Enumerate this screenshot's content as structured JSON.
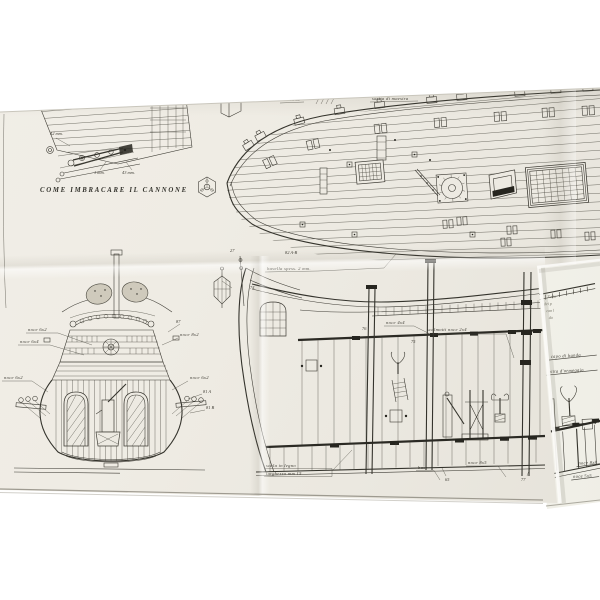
{
  "palette": {
    "paper": "#efece4",
    "paper_under": "#f6f5f0",
    "ink": "#3e3c35",
    "shadow": "#b9b5a9"
  },
  "sheet": {
    "cannon": {
      "caption": "COME IMBRACARE IL CANNONE",
      "dims": [
        "42 mm.",
        "1 mm.",
        "43 mm."
      ]
    },
    "deck": {
      "mezzana": "mezzana",
      "sartia": "sartia di maestra",
      "n82": "82 A-B",
      "bavella": "bavella spess. 2 mm.",
      "n27": "27",
      "n74": "74"
    },
    "stern": {
      "noce62a": "noce 6x2",
      "noce64": "noce 6x4",
      "noce62b": "noce 6x2",
      "n87": "87",
      "noce82": "noce 8x2",
      "noce62c": "noce 6x2",
      "n81a": "81 A",
      "n81b": "81 B"
    },
    "section": {
      "noce44": "noce 4x4",
      "scalmotti": "scalmotti noce 2x4",
      "n76": "76",
      "n75": "75",
      "scala": "scala in legno",
      "larghezza": "larghezza mm 15",
      "base": "base",
      "n65": "65",
      "noce85": "noce 8x5",
      "n77": "77"
    },
    "panel": {
      "notes": [
        "Tutta",
        "dei p",
        "con l",
        "da"
      ],
      "capo": "capo di banda",
      "bitta": "bitta d'ormeggio",
      "noce88": "noce 8x8",
      "noce55": "noce 5x5"
    }
  }
}
